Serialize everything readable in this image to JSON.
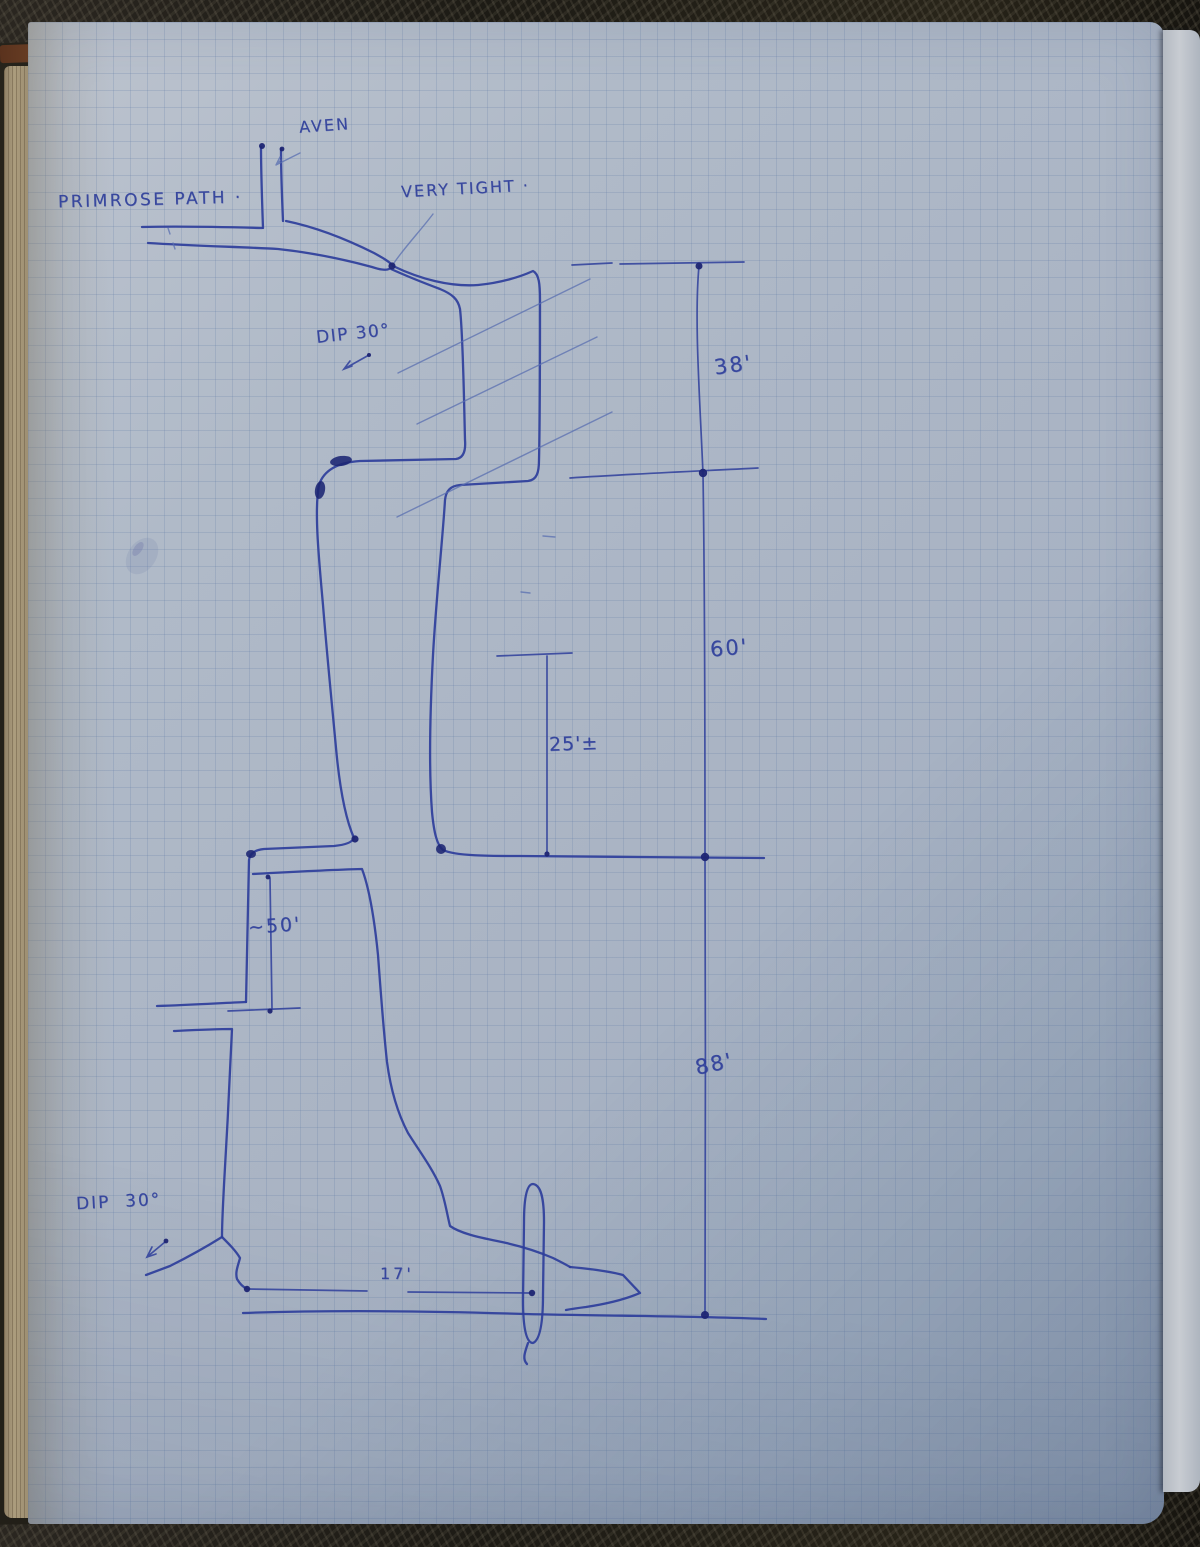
{
  "colors": {
    "paper": "#aab4c4",
    "paper-light": "#bcc3ce",
    "paper-dark": "#92a1b6",
    "grid": "rgba(95,122,165,0.22)",
    "ink": "#2e3e9b",
    "ink-dark": "#1d2573",
    "ink-light": "#5a6fb0",
    "surface": "#221f18",
    "edge-tan": "#a79878",
    "next-page": "#c8ccd2"
  },
  "labels": {
    "passage_name": "PRIMROSE PATH ·",
    "aven": "AVEN",
    "very_tight": "VERY TIGHT ·",
    "dip_upper": "DIP 30°",
    "dip_lower": "DIP  30°"
  },
  "measurements": {
    "segment_38": "38'",
    "segment_60": "60'",
    "segment_88": "88'",
    "width_25": "25'±",
    "climb_50": "~50'",
    "width_17": "17'"
  }
}
